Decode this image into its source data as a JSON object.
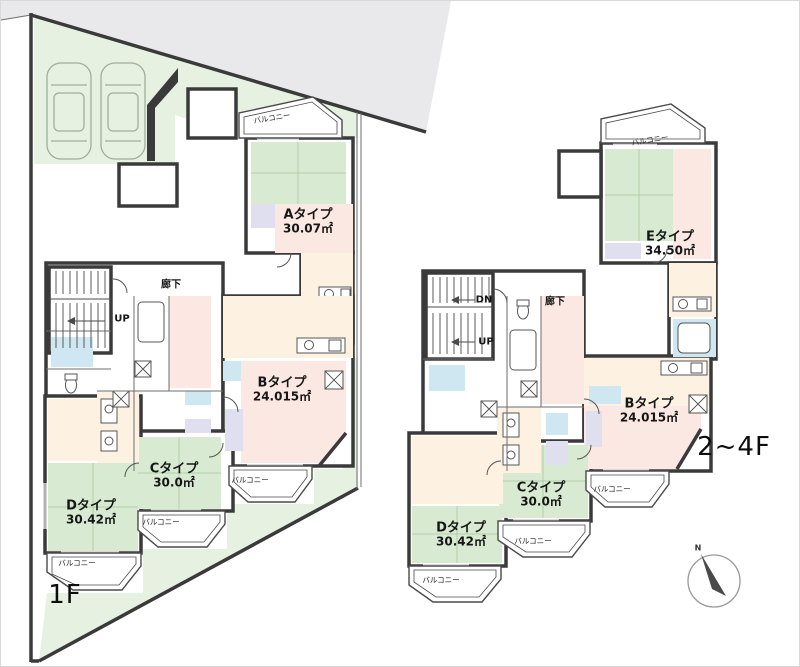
{
  "colors": {
    "wall": "#3a3a3a",
    "site_green": "#e7f1e2",
    "tatami_green": "#d8ead1",
    "room_pink": "#fbe8e2",
    "room_cream": "#fdf2e2",
    "bath_blue": "#cfe7f1",
    "closet_lavender": "#dfdff0",
    "neighbor_gray": "#e9e9eb"
  },
  "plans": {
    "floor1": {
      "floor_label": "1F",
      "corridor_label": "廊下",
      "balcony_label": "バルコニー",
      "stairs": {
        "up_label": "UP"
      },
      "parking": {
        "car_count": 2
      },
      "units": [
        {
          "id": "A",
          "name": "Aタイプ",
          "area": "30.07㎡"
        },
        {
          "id": "B",
          "name": "Bタイプ",
          "area": "24.015㎡"
        },
        {
          "id": "C",
          "name": "Cタイプ",
          "area": "30.0㎡"
        },
        {
          "id": "D",
          "name": "Dタイプ",
          "area": "30.42㎡"
        }
      ]
    },
    "upper": {
      "floor_label": "2~4F",
      "corridor_label": "廊下",
      "balcony_label": "バルコニー",
      "stairs": {
        "down_label": "DN",
        "up_label": "UP"
      },
      "units": [
        {
          "id": "E",
          "name": "Eタイプ",
          "area": "34.50㎡"
        },
        {
          "id": "B",
          "name": "Bタイプ",
          "area": "24.015㎡"
        },
        {
          "id": "C",
          "name": "Cタイプ",
          "area": "30.0㎡"
        },
        {
          "id": "D",
          "name": "Dタイプ",
          "area": "30.42㎡"
        }
      ]
    }
  },
  "compass": {
    "label": "N"
  }
}
